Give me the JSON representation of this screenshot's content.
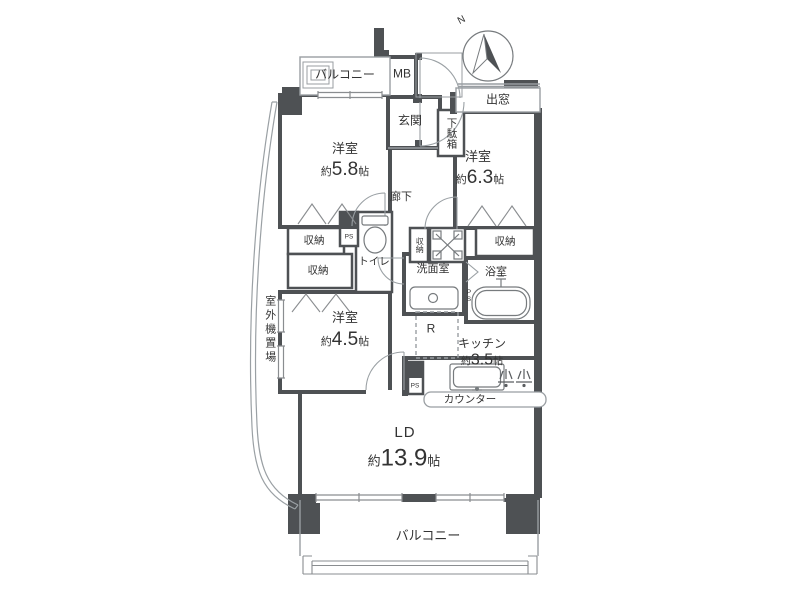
{
  "colors": {
    "wall": "#4e5154",
    "thin_line": "#999ea2",
    "text": "#333333",
    "background": "#ffffff"
  },
  "compass": {
    "north_label": "N"
  },
  "labels": {
    "balcony_top": "バルコニー",
    "meter_box": "MB",
    "entrance": "玄関",
    "shoe_cabinet": "下駄箱",
    "bay_window": "出窓",
    "corridor": "廊下",
    "toilet": "トイレ",
    "washroom": "洗面室",
    "bathroom": "浴室",
    "pipe_space": "PS",
    "refrigerator_space": "R",
    "counter": "カウンター",
    "balcony_bottom": "バルコニー",
    "outdoor_unit_space": "室外機置場"
  },
  "closets": {
    "bedroom1_upper": "収納",
    "bedroom1_lower": "収納",
    "hall": "収納",
    "bedroom2": "収納"
  },
  "rooms": {
    "bedroom1": {
      "name": "洋室",
      "size_prefix": "約",
      "size_value": "5.8",
      "size_unit": "帖"
    },
    "bedroom2": {
      "name": "洋室",
      "size_prefix": "約",
      "size_value": "6.3",
      "size_unit": "帖"
    },
    "bedroom3": {
      "name": "洋室",
      "size_prefix": "約",
      "size_value": "4.5",
      "size_unit": "帖"
    },
    "kitchen": {
      "name": "キッチン",
      "size_prefix": "約",
      "size_value": "3.5",
      "size_unit": "帖"
    },
    "living_dining": {
      "name": "LD",
      "size_prefix": "約",
      "size_value": "13.9",
      "size_unit": "帖"
    }
  }
}
